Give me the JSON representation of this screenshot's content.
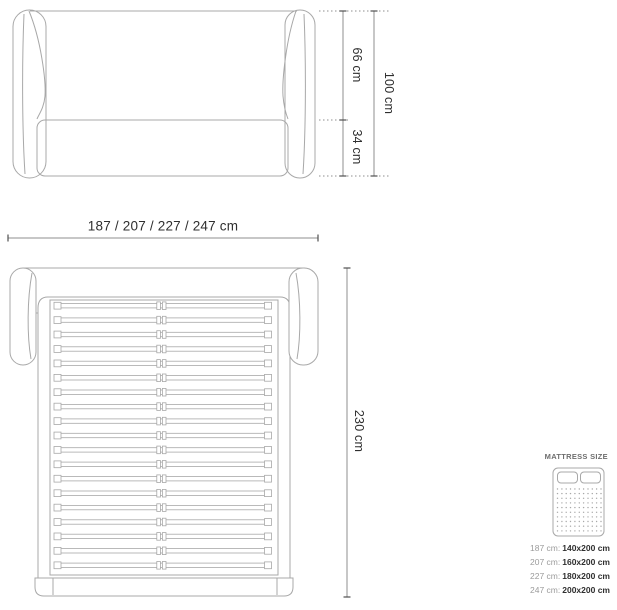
{
  "front_view": {
    "upper_label": "66 cm",
    "lower_label": "34 cm",
    "total_label": "100 cm"
  },
  "width_dimension": {
    "label": "187 / 207 / 227 / 247 cm"
  },
  "top_view": {
    "length_label": "230 cm",
    "slat_count": 19
  },
  "legend": {
    "title": "MATTRESS SIZE",
    "rows": [
      {
        "frame": "187 cm:",
        "mattress": "140x200 cm"
      },
      {
        "frame": "207 cm:",
        "mattress": "160x200 cm"
      },
      {
        "frame": "227 cm:",
        "mattress": "180x200 cm"
      },
      {
        "frame": "247 cm:",
        "mattress": "200x200 cm"
      }
    ],
    "icon": {
      "dot_rows": 10,
      "dot_cols": 11
    }
  },
  "colors": {
    "line": "#a8a8a8",
    "dim_line": "#8f8f8f",
    "tick": "#4f4f4f",
    "text": "#2f2f2f",
    "muted_text": "#9b9b9b",
    "background": "#ffffff"
  }
}
